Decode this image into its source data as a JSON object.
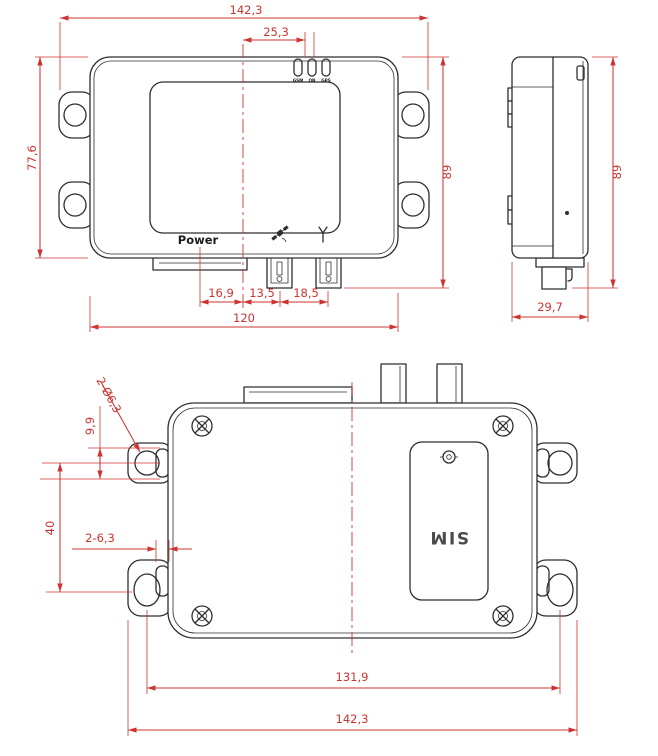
{
  "drawing": {
    "units": "mm",
    "colors": {
      "outline": "#2e2e2e",
      "dimension": "#cd3431",
      "background": "#ffffff"
    },
    "front": {
      "dim_overall_width": "142,3",
      "dim_led_offset": "25,3",
      "dim_body_height": "77,6",
      "dim_overall_height": "89",
      "dim_power_to_center": "16,9",
      "dim_center_to_gps": "13,5",
      "dim_gps_to_antenna": "18,5",
      "dim_body_width": "120",
      "power_label": "Power",
      "led_labels": [
        "GSM",
        "ON",
        "GPS"
      ],
      "icons": {
        "gps": "satellite-icon",
        "cellular": "antenna-signal-icon"
      }
    },
    "side": {
      "dim_overall_height": "89",
      "dim_depth": "29,7"
    },
    "bottom": {
      "callout_mount_holes": "2-Ø6,3",
      "dim_hole_edge": "9,9",
      "dim_hole_spacing_vertical": "40",
      "callout_slots": "2-6,3",
      "dim_hole_spacing_horizontal": "131,9",
      "dim_overall_width": "142,3",
      "sim_label": "SIM"
    }
  }
}
